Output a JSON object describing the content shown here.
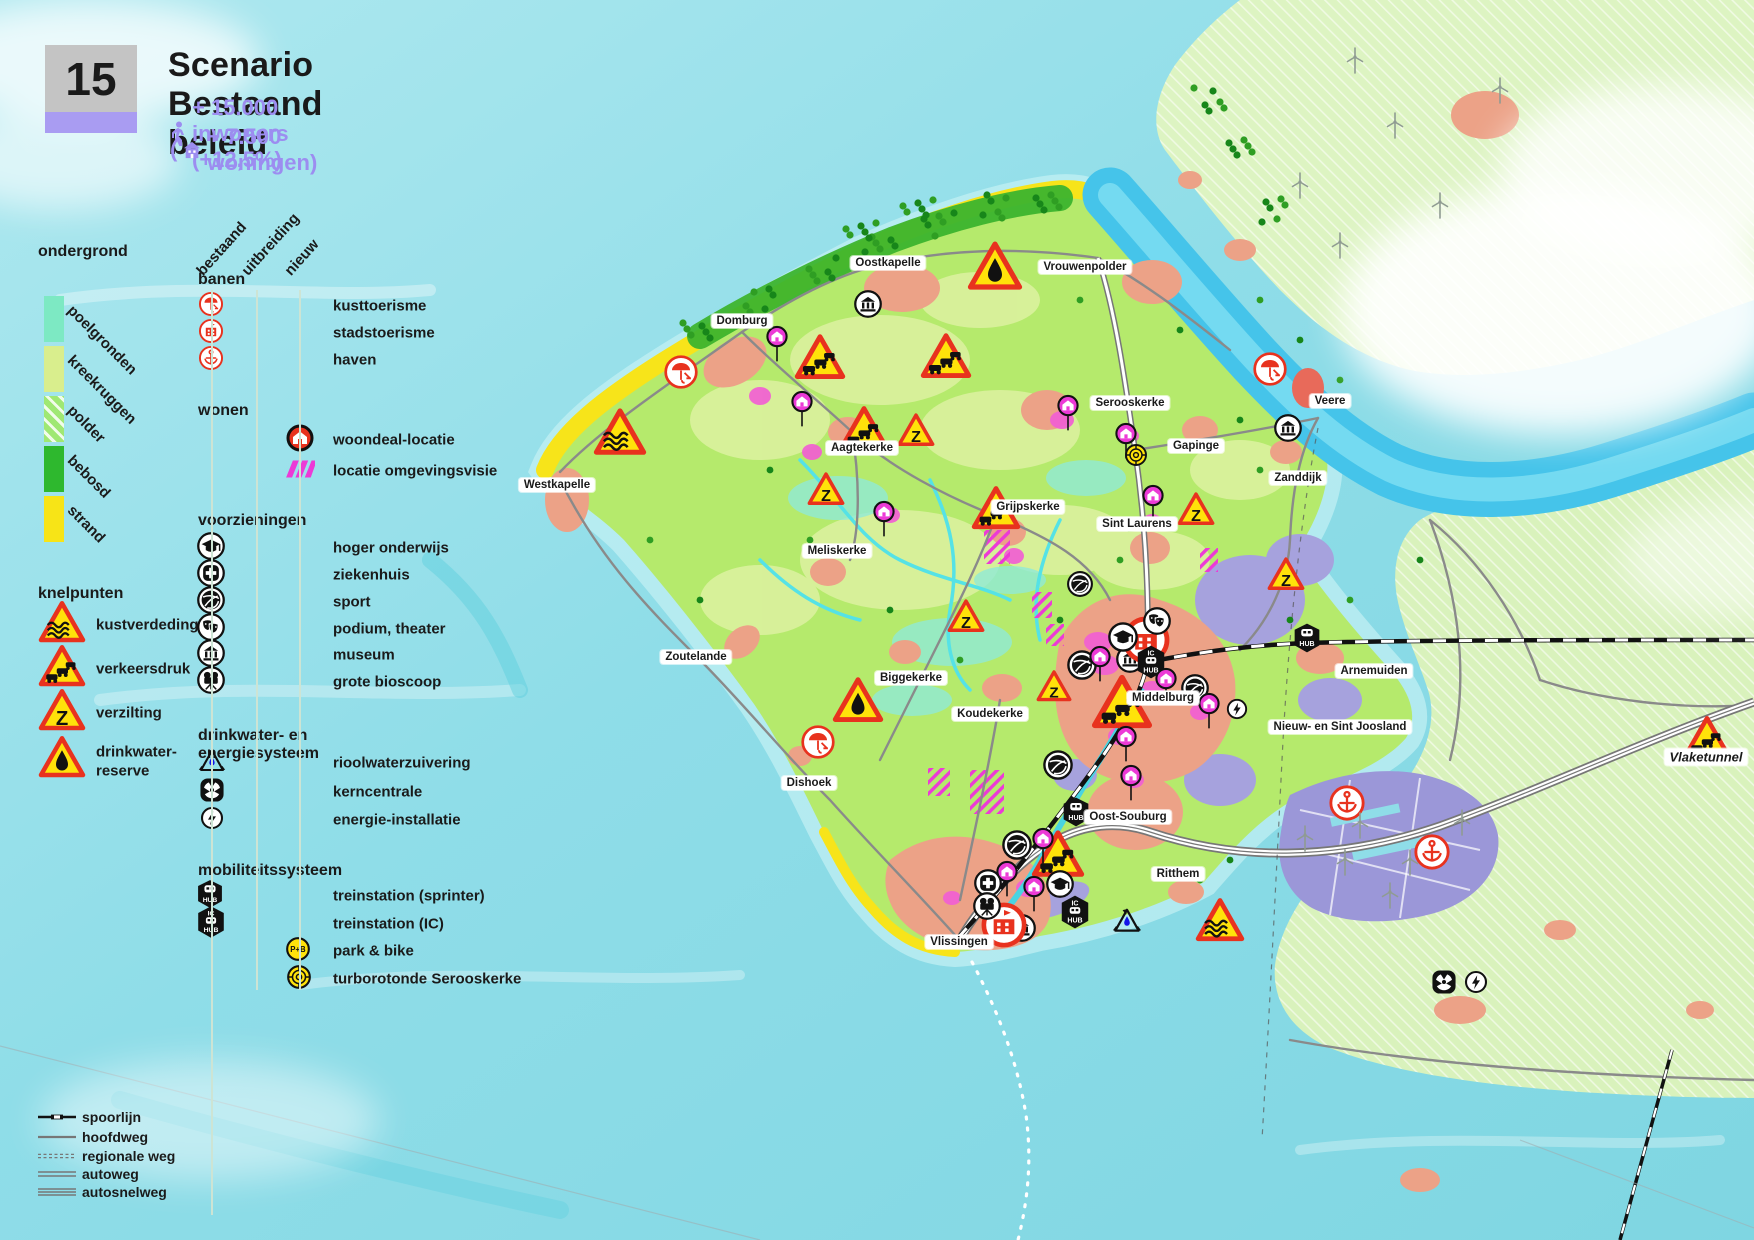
{
  "header": {
    "number": "15",
    "title": "Scenario Bestaand beleid",
    "population_line": "+ 15.000 inwoners (+12,5%)",
    "housing_prefix": "(",
    "housing_line": "+ 7.500 woningen)"
  },
  "colors": {
    "accent_purple": "#9c8df0",
    "number_box_grey": "#c4c4c4",
    "number_bar_purple": "#a99cf2",
    "warning_red": "#e8321e",
    "warning_yellow": "#ffe20a",
    "magenta": "#ec3ad6",
    "sea": "#8fdde8",
    "strand_yellow": "#f7e41a",
    "forest_green": "#3cb42e",
    "island_green": "#b5ea6c",
    "harbor_purple": "#9b97d8",
    "town_salmon": "#eca287"
  },
  "legend_left": {
    "ondergrond_title": "ondergrond",
    "ondergrond_items": [
      {
        "label": "poelgronden",
        "color": "#7de9c3",
        "hatch": false
      },
      {
        "label": "kreekruggen",
        "color": "#d9ee8d",
        "hatch": false
      },
      {
        "label": "polder",
        "color": "#9fe873",
        "hatch": true
      },
      {
        "label": "bebosd",
        "color": "#2eb82e",
        "hatch": false
      },
      {
        "label": "strand",
        "color": "#f7e417",
        "hatch": false
      }
    ],
    "knelpunten_title": "knelpunten",
    "knelpunten_items": [
      {
        "label": "kustverdeding",
        "icon": "tri-waves"
      },
      {
        "label": "verkeersdruk",
        "icon": "tri-cars"
      },
      {
        "label": "verzilting",
        "icon": "tri-z"
      },
      {
        "label": "drinkwater-",
        "label2": "reserve",
        "icon": "tri-drop"
      }
    ]
  },
  "legend_columns": {
    "headers": [
      "bestaand",
      "uitbreiding",
      "nieuw"
    ]
  },
  "legend_main": {
    "banen": {
      "title": "banen",
      "rows": [
        {
          "label": "kusttoerisme",
          "icon": "umbrella-red"
        },
        {
          "label": "stadstoerisme",
          "icon": "building-red"
        },
        {
          "label": "haven",
          "icon": "anchor-red"
        }
      ]
    },
    "wonen": {
      "title": "wonen",
      "rows": [
        {
          "label": "woondeal-locatie",
          "icon": "house-pin"
        },
        {
          "label": "locatie omgevingsvisie",
          "icon": "hatch-magenta"
        }
      ]
    },
    "voorzieningen": {
      "title": "voorzieningen",
      "rows": [
        {
          "label": "hoger onderwijs",
          "icon": "grad-cap"
        },
        {
          "label": "ziekenhuis",
          "icon": "hospital"
        },
        {
          "label": "sport",
          "icon": "sport"
        },
        {
          "label": "podium, theater",
          "icon": "theater-masks"
        },
        {
          "label": "museum",
          "icon": "museum"
        },
        {
          "label": "grote bioscoop",
          "icon": "projector"
        }
      ]
    },
    "drinkwater": {
      "title": "drinkwater- en energiesysteem",
      "rows": [
        {
          "label": "rioolwaterzuivering",
          "icon": "recycle-water"
        },
        {
          "label": "kerncentrale",
          "icon": "nuclear"
        },
        {
          "label": "energie-installatie",
          "icon": "lightning"
        }
      ]
    },
    "mobiliteit": {
      "title": "mobiliteitssysteem",
      "rows": [
        {
          "label": "treinstation (sprinter)",
          "icon": "hub-sprinter"
        },
        {
          "label": "treinstation (IC)",
          "icon": "hub-ic"
        },
        {
          "label": "park & bike",
          "icon": "park-bike"
        },
        {
          "label": "turborotonde Serooskerke",
          "icon": "turbo-roundabout"
        }
      ]
    }
  },
  "legend_roads": {
    "rows": [
      {
        "label": "spoorlijn",
        "icon": "rail-sample"
      },
      {
        "label": "hoofdweg",
        "icon": "road-main"
      },
      {
        "label": "regionale weg",
        "icon": "road-regional"
      },
      {
        "label": "autoweg",
        "icon": "road-autoweg"
      },
      {
        "label": "autosnelweg",
        "icon": "road-motorway"
      }
    ]
  },
  "map": {
    "towns": [
      {
        "name": "Domburg",
        "x": 742,
        "y": 321
      },
      {
        "name": "Oostkapelle",
        "x": 888,
        "y": 263
      },
      {
        "name": "Vrouwenpolder",
        "x": 1085,
        "y": 267
      },
      {
        "name": "Westkapelle",
        "x": 557,
        "y": 485
      },
      {
        "name": "Aagtekerke",
        "x": 862,
        "y": 448
      },
      {
        "name": "Serooskerke",
        "x": 1130,
        "y": 403
      },
      {
        "name": "Gapinge",
        "x": 1196,
        "y": 446
      },
      {
        "name": "Veere",
        "x": 1330,
        "y": 401
      },
      {
        "name": "Zanddijk",
        "x": 1298,
        "y": 478
      },
      {
        "name": "Sint Laurens",
        "x": 1137,
        "y": 524
      },
      {
        "name": "Grijpskerke",
        "x": 1028,
        "y": 507
      },
      {
        "name": "Meliskerke",
        "x": 837,
        "y": 551
      },
      {
        "name": "Zoutelande",
        "x": 696,
        "y": 657
      },
      {
        "name": "Biggekerke",
        "x": 911,
        "y": 678
      },
      {
        "name": "Koudekerke",
        "x": 990,
        "y": 714
      },
      {
        "name": "Middelburg",
        "x": 1163,
        "y": 698
      },
      {
        "name": "Arnemuiden",
        "x": 1374,
        "y": 671
      },
      {
        "name": "Nieuw- en Sint Joosland",
        "x": 1340,
        "y": 727
      },
      {
        "name": "Dishoek",
        "x": 809,
        "y": 783
      },
      {
        "name": "Oost-Souburg",
        "x": 1128,
        "y": 817
      },
      {
        "name": "Ritthem",
        "x": 1178,
        "y": 874
      },
      {
        "name": "Vlissingen",
        "x": 959,
        "y": 942
      },
      {
        "name": "Vlaketunnel",
        "x": 1706,
        "y": 757,
        "italic": true
      }
    ],
    "markers": [
      {
        "t": "tri-drop",
        "x": 995,
        "y": 266,
        "s": 56
      },
      {
        "t": "tri-cars",
        "x": 820,
        "y": 357,
        "s": 52
      },
      {
        "t": "tri-cars",
        "x": 946,
        "y": 356,
        "s": 52
      },
      {
        "t": "tri-cars",
        "x": 864,
        "y": 428,
        "s": 50
      },
      {
        "t": "tri-z",
        "x": 916,
        "y": 430,
        "s": 38
      },
      {
        "t": "tri-waves",
        "x": 620,
        "y": 432,
        "s": 54
      },
      {
        "t": "tri-z",
        "x": 826,
        "y": 489,
        "s": 38
      },
      {
        "t": "tri-cars",
        "x": 996,
        "y": 508,
        "s": 50
      },
      {
        "t": "tri-z",
        "x": 1196,
        "y": 509,
        "s": 38
      },
      {
        "t": "tri-z",
        "x": 1286,
        "y": 574,
        "s": 38
      },
      {
        "t": "tri-z",
        "x": 966,
        "y": 616,
        "s": 38
      },
      {
        "t": "tri-drop",
        "x": 858,
        "y": 700,
        "s": 52
      },
      {
        "t": "tri-z",
        "x": 1054,
        "y": 686,
        "s": 36
      },
      {
        "t": "tri-cars",
        "x": 1122,
        "y": 702,
        "s": 62
      },
      {
        "t": "tri-cars",
        "x": 1058,
        "y": 854,
        "s": 54
      },
      {
        "t": "tri-waves",
        "x": 1220,
        "y": 920,
        "s": 50
      },
      {
        "t": "tri-cars",
        "x": 1707,
        "y": 737,
        "s": 48
      },
      {
        "t": "umbrella-red",
        "x": 681,
        "y": 372,
        "s": 36
      },
      {
        "t": "umbrella-red",
        "x": 818,
        "y": 742,
        "s": 36
      },
      {
        "t": "umbrella-red",
        "x": 1270,
        "y": 369,
        "s": 36
      },
      {
        "t": "museum",
        "x": 868,
        "y": 304,
        "s": 30
      },
      {
        "t": "museum",
        "x": 1288,
        "y": 428,
        "s": 30
      },
      {
        "t": "museum",
        "x": 1130,
        "y": 659,
        "s": 30
      },
      {
        "t": "museum",
        "x": 1022,
        "y": 928,
        "s": 30
      },
      {
        "t": "city-big",
        "x": 1146,
        "y": 640,
        "s": 48
      },
      {
        "t": "city-big",
        "x": 1004,
        "y": 925,
        "s": 46
      },
      {
        "t": "anchor-red",
        "x": 1347,
        "y": 803,
        "s": 38
      },
      {
        "t": "anchor-red",
        "x": 1432,
        "y": 852,
        "s": 38
      },
      {
        "t": "hub-sprinter",
        "x": 1076,
        "y": 812,
        "s": 28
      },
      {
        "t": "hub-sprinter",
        "x": 1307,
        "y": 638,
        "s": 28
      },
      {
        "t": "hub-ic",
        "x": 1151,
        "y": 662,
        "s": 30
      },
      {
        "t": "hub-ic",
        "x": 1075,
        "y": 912,
        "s": 30
      },
      {
        "t": "sport",
        "x": 1082,
        "y": 665,
        "s": 32
      },
      {
        "t": "sport",
        "x": 1195,
        "y": 688,
        "s": 30
      },
      {
        "t": "sport",
        "x": 1058,
        "y": 765,
        "s": 32
      },
      {
        "t": "sport",
        "x": 1017,
        "y": 845,
        "s": 32
      },
      {
        "t": "sport",
        "x": 1080,
        "y": 584,
        "s": 28
      },
      {
        "t": "grad-cap",
        "x": 1123,
        "y": 637,
        "s": 32
      },
      {
        "t": "grad-cap",
        "x": 1060,
        "y": 884,
        "s": 30
      },
      {
        "t": "hospital",
        "x": 988,
        "y": 883,
        "s": 30
      },
      {
        "t": "theater-masks",
        "x": 1157,
        "y": 621,
        "s": 30
      },
      {
        "t": "projector",
        "x": 987,
        "y": 906,
        "s": 30
      },
      {
        "t": "recycle-water",
        "x": 1127,
        "y": 921,
        "s": 32
      },
      {
        "t": "nuclear",
        "x": 1444,
        "y": 982,
        "s": 26
      },
      {
        "t": "lightning",
        "x": 1476,
        "y": 982,
        "s": 24
      },
      {
        "t": "lightning",
        "x": 1237,
        "y": 709,
        "s": 22
      },
      {
        "t": "turbo-roundabout",
        "x": 1136,
        "y": 455,
        "s": 24
      },
      {
        "t": "house-pin-stem",
        "x": 777,
        "y": 333,
        "s": 24
      },
      {
        "t": "house-pin-stem",
        "x": 802,
        "y": 398,
        "s": 24
      },
      {
        "t": "house-pin-stem",
        "x": 884,
        "y": 508,
        "s": 24
      },
      {
        "t": "house-pin-stem",
        "x": 1068,
        "y": 402,
        "s": 24
      },
      {
        "t": "house-pin-stem",
        "x": 1126,
        "y": 430,
        "s": 24
      },
      {
        "t": "house-pin-stem",
        "x": 1153,
        "y": 492,
        "s": 24
      },
      {
        "t": "house-pin-stem",
        "x": 1100,
        "y": 653,
        "s": 24
      },
      {
        "t": "house-pin-stem",
        "x": 1166,
        "y": 675,
        "s": 24
      },
      {
        "t": "house-pin-stem",
        "x": 1209,
        "y": 700,
        "s": 24
      },
      {
        "t": "house-pin-stem",
        "x": 1126,
        "y": 733,
        "s": 24
      },
      {
        "t": "house-pin-stem",
        "x": 1131,
        "y": 772,
        "s": 24
      },
      {
        "t": "house-pin-stem",
        "x": 1043,
        "y": 835,
        "s": 24
      },
      {
        "t": "house-pin-stem",
        "x": 1034,
        "y": 883,
        "s": 24
      },
      {
        "t": "house-pin-stem",
        "x": 1007,
        "y": 868,
        "s": 24
      },
      {
        "t": "turbine",
        "x": 1355,
        "y": 60,
        "s": 20
      },
      {
        "t": "turbine",
        "x": 1395,
        "y": 125,
        "s": 20
      },
      {
        "t": "turbine",
        "x": 1300,
        "y": 185,
        "s": 20
      },
      {
        "t": "turbine",
        "x": 1440,
        "y": 205,
        "s": 20
      },
      {
        "t": "turbine",
        "x": 1340,
        "y": 245,
        "s": 20
      },
      {
        "t": "turbine",
        "x": 1500,
        "y": 90,
        "s": 20
      },
      {
        "t": "turbine",
        "x": 1360,
        "y": 825,
        "s": 20
      },
      {
        "t": "turbine",
        "x": 1410,
        "y": 862,
        "s": 20
      },
      {
        "t": "turbine",
        "x": 1345,
        "y": 862,
        "s": 20
      },
      {
        "t": "turbine",
        "x": 1462,
        "y": 822,
        "s": 20
      },
      {
        "t": "turbine",
        "x": 1305,
        "y": 838,
        "s": 20
      },
      {
        "t": "turbine",
        "x": 1390,
        "y": 895,
        "s": 20
      }
    ]
  }
}
